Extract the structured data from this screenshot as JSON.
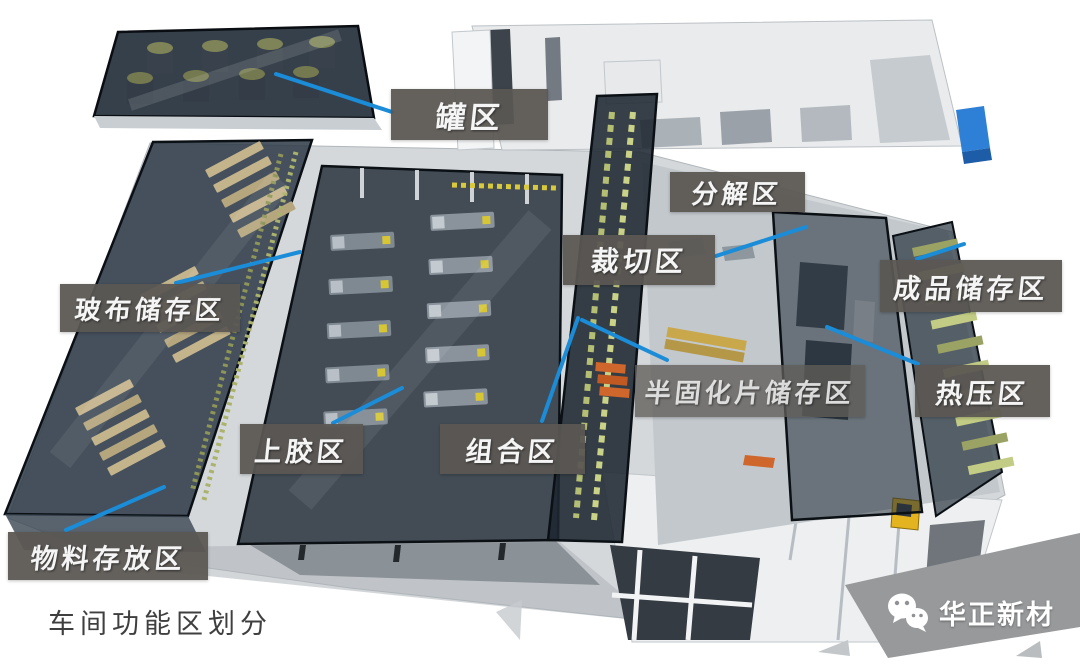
{
  "diagram": {
    "caption": "车间功能区划分",
    "watermark": {
      "text": "华正新材",
      "icon": "wechat-icon"
    },
    "zone_labels": {
      "tank_area": "罐区",
      "decomposition_area": "分解区",
      "cutting_area": "裁切区",
      "glass_cloth_storage_area": "玻布储存区",
      "finished_product_storage_area": "成品储存区",
      "prepreg_storage_area": "半固化片储存区",
      "hot_press_area": "热压区",
      "gluing_area": "上胶区",
      "assembly_area": "组合区",
      "material_storage_area": "物料存放区"
    },
    "colors": {
      "label_background": "#5a5753",
      "label_text": "#f5f5f5",
      "leader_line": "#1b8cd8",
      "caption_text": "#3f3f3f",
      "watermark_text": "#ffffff",
      "zone_highlight": "#25303b",
      "rack_tan": "#c4b48c",
      "rack_olive": "#9aa364",
      "pallet_orange": "#cf662b",
      "forklift_yellow": "#e3b41f",
      "machine_blue": "#2e7fd6"
    }
  }
}
